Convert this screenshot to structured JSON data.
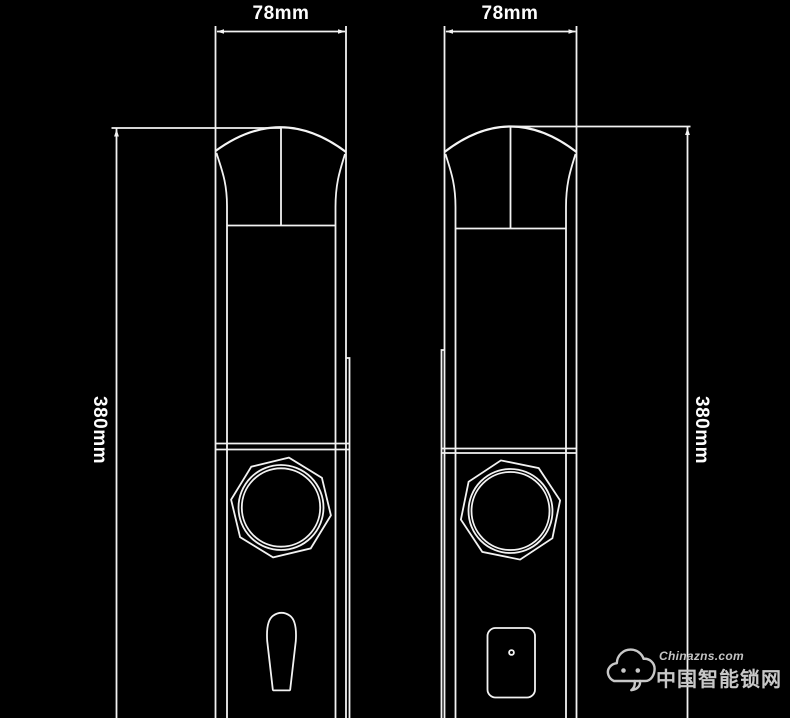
{
  "drawing": {
    "type": "technical-dimension-drawing",
    "subject": "smart door lock front and back panels",
    "background_color": "#000000",
    "line_color": "#f2f2f2",
    "watermark_color": "#c8c8c8"
  },
  "dimensions": {
    "front_width_label": "78mm",
    "back_width_label": "78mm",
    "front_height_label": "380mm",
    "back_height_label": "380mm"
  },
  "watermark": {
    "url_text": "Chinazns.com",
    "brand_text": "中国智能锁网",
    "icon": "cloud-mascot-icon"
  }
}
